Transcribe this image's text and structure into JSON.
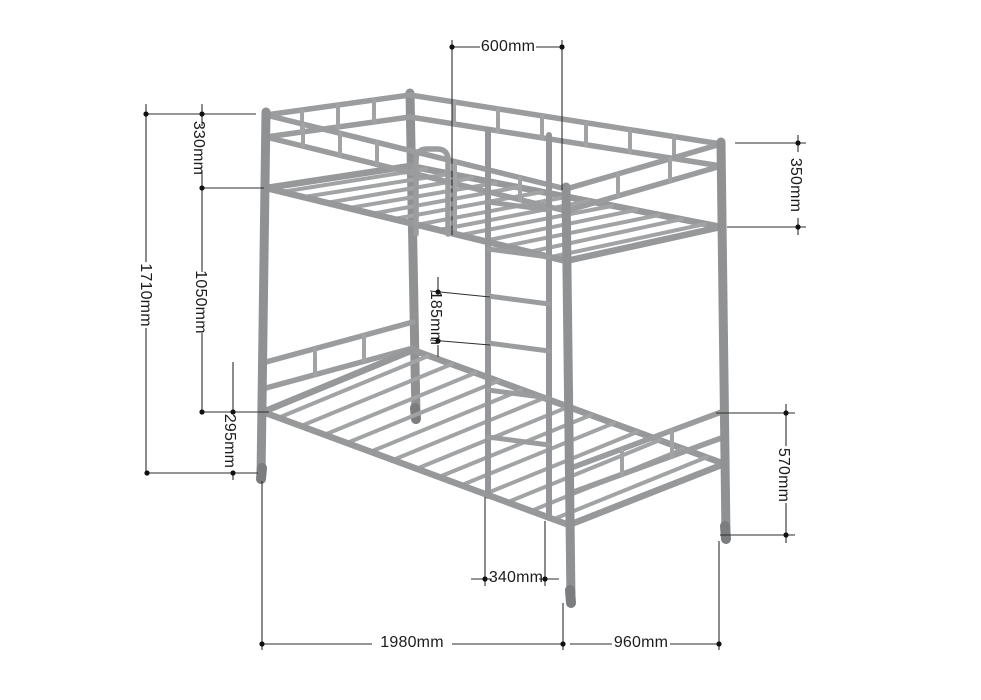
{
  "diagram": {
    "type": "technical dimension drawing",
    "subject": "metal bunk bed frame, isometric view",
    "units": "mm",
    "colors": {
      "background": "#ffffff",
      "frame_gray": "#97999b",
      "dimension_line": "#2e2e2e",
      "text": "#1c1c1c"
    },
    "dimensions": [
      {
        "id": "d600",
        "label": "600mm",
        "orientation": "horizontal",
        "measures": "ladder entry opening on top guard rail"
      },
      {
        "id": "d330",
        "label": "330mm",
        "orientation": "vertical",
        "measures": "guard rail height above upper bunk rail (left)"
      },
      {
        "id": "d1710",
        "label": "1710mm",
        "orientation": "vertical",
        "measures": "overall height"
      },
      {
        "id": "d1050",
        "label": "1050mm",
        "orientation": "vertical",
        "measures": "upper bunk rail to lower bunk rail"
      },
      {
        "id": "d295",
        "label": "295mm",
        "orientation": "vertical",
        "measures": "lower bunk rail height above floor"
      },
      {
        "id": "d350",
        "label": "350mm",
        "orientation": "vertical",
        "measures": "guard rail height at right end"
      },
      {
        "id": "d185",
        "label": "185mm",
        "orientation": "vertical",
        "measures": "ladder rung spacing"
      },
      {
        "id": "d340",
        "label": "340mm",
        "orientation": "horizontal",
        "measures": "ladder width"
      },
      {
        "id": "d570",
        "label": "570mm",
        "orientation": "vertical",
        "measures": "floor to lower end rail (right)"
      },
      {
        "id": "d1980",
        "label": "1980mm",
        "orientation": "horizontal",
        "measures": "overall length"
      },
      {
        "id": "d960",
        "label": "960mm",
        "orientation": "horizontal",
        "measures": "overall width"
      }
    ]
  }
}
